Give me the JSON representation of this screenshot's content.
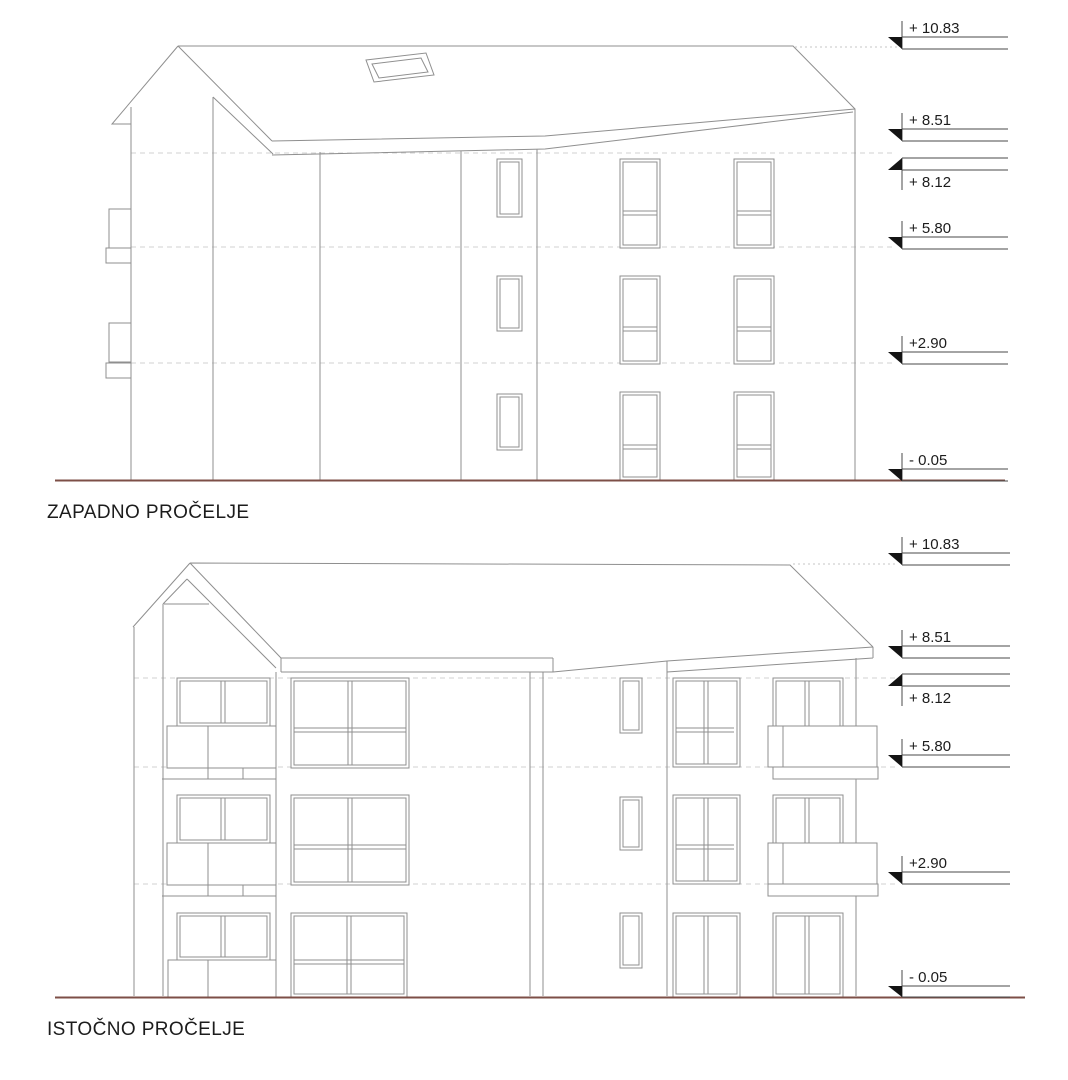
{
  "sheet": {
    "background": "#ffffff",
    "type": "architectural elevation drawings"
  },
  "colors": {
    "drawing_line": "#8f8f8f",
    "dashed_level_line": "#d2d2d2",
    "ground_line": "#7d4f47",
    "marker_ink": "#141414",
    "text": "#1c1c1c"
  },
  "drawings": [
    {
      "title": "ZAPADNO PROČELJE",
      "markers": [
        "+ 10.83",
        "+ 8.51",
        "+ 8.12",
        "+ 5.80",
        "+2.90",
        "- 0.05"
      ]
    },
    {
      "title": "ISTOČNO PROČELJE",
      "markers": [
        "+ 10.83",
        "+ 8.51",
        "+ 8.12",
        "+ 5.80",
        "+2.90",
        "- 0.05"
      ]
    }
  ]
}
